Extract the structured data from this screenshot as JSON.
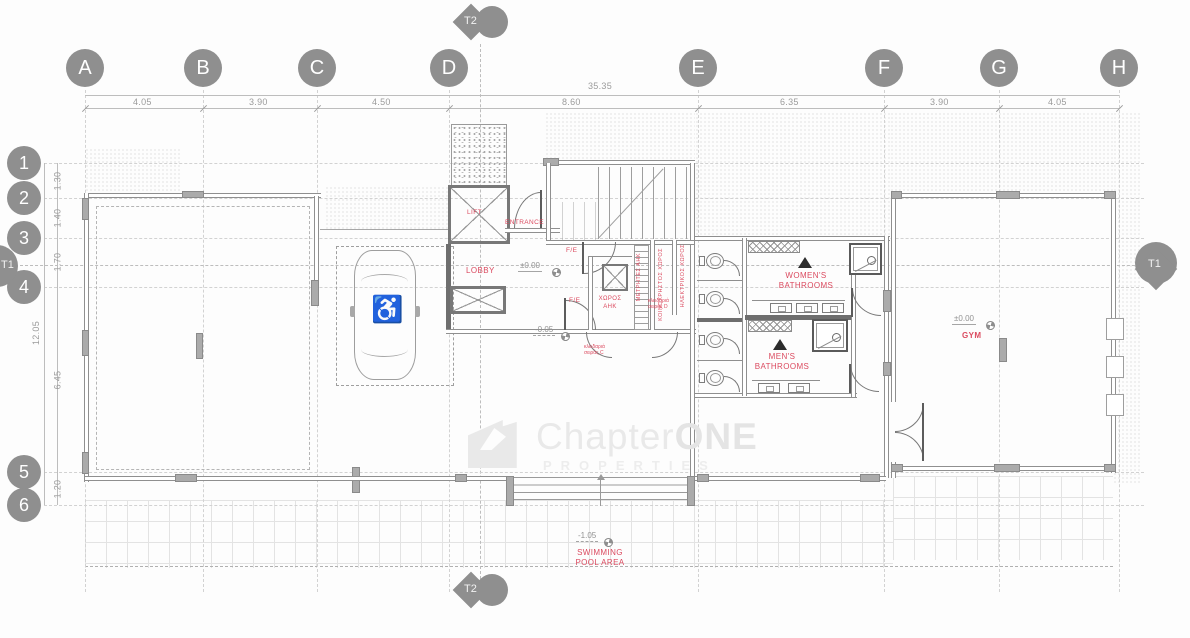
{
  "watermark": {
    "brand_main": "Chapter",
    "brand_accent": "ONE",
    "brand_sub": "PROPERTIES"
  },
  "grid": {
    "columns": [
      {
        "label": "A"
      },
      {
        "label": "B"
      },
      {
        "label": "C"
      },
      {
        "label": "D"
      },
      {
        "label": "E"
      },
      {
        "label": "F"
      },
      {
        "label": "G"
      },
      {
        "label": "H"
      }
    ],
    "rows": [
      {
        "label": "1"
      },
      {
        "label": "2"
      },
      {
        "label": "3"
      },
      {
        "label": "4"
      },
      {
        "label": "5"
      },
      {
        "label": "6"
      }
    ],
    "sections": {
      "top": "T2",
      "bottom": "T2",
      "left": "T1",
      "right": "T1"
    },
    "dims_top": {
      "total": "35.35",
      "segments": [
        "4.05",
        "3.90",
        "4.50",
        "8.60",
        "6.35",
        "3.90",
        "4.05"
      ]
    },
    "dims_left": {
      "total": "12.05",
      "segments": [
        "1.30",
        "1.40",
        "1.70",
        "6.45",
        "1.20"
      ]
    }
  },
  "rooms": {
    "lift": "LIFT",
    "entrance": "ENTRANCE",
    "lobby": "LOBBY",
    "fe_upper": "F/E",
    "fe_lower": "F/E",
    "ahk_line1": "ΧΩΡΟΣ",
    "ahk_line2": "ΑΗΚ",
    "meters": "ΜΕΤΡΗΤΕΣ ΑΗΚ",
    "common_area": "ΚΟΙΝΟΧΡΗΣΤΟΣ ΧΩΡΟΣ",
    "electrical": "ΗΛΕΚΤΡΙΚΟΣ ΧΩΡΟΣ",
    "womens_line1": "WOMEN'S",
    "womens_line2": "BATHROOMS",
    "mens_line1": "MEN'S",
    "mens_line2": "BATHROOMS",
    "gym": "GYM",
    "pool_line1": "SWIMMING",
    "pool_line2": "POOL AREA"
  },
  "notes": {
    "lock_c": "κλειδαριά σειράς C",
    "lock_d": "κλειδαριά σειράς D"
  },
  "levels": {
    "lobby": "±0.00",
    "lobby_lower": "-0.05",
    "gym": "±0.00",
    "pool": "-1.05"
  },
  "colors": {
    "label_red": "#db4a5f",
    "grid_gray": "#8f8f8f",
    "line_gray": "#9b9b9b",
    "wall_dark": "#6e6e6e",
    "watermark_gray": "#e9e9e9"
  }
}
